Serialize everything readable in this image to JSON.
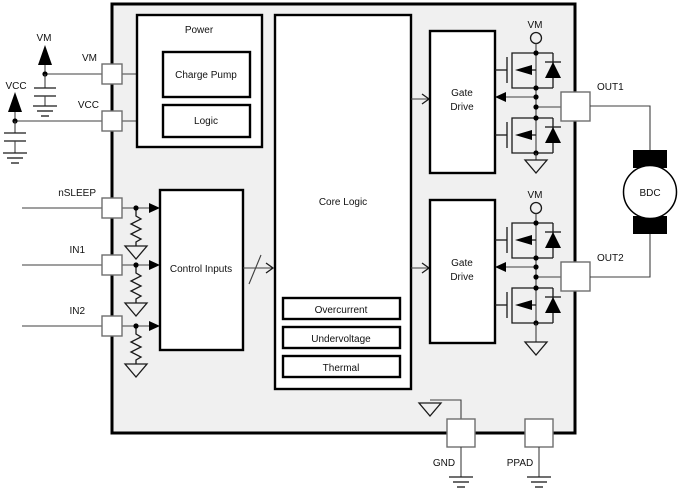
{
  "blocks": {
    "power": "Power",
    "charge_pump": "Charge Pump",
    "logic": "Logic",
    "core_logic": "Core Logic",
    "control_inputs": "Control Inputs",
    "overcurrent": "Overcurrent",
    "undervoltage": "Undervoltage",
    "thermal": "Thermal",
    "gate_drive_line1": "Gate",
    "gate_drive_line2": "Drive",
    "motor": "BDC"
  },
  "pins": {
    "vm": "VM",
    "vcc": "VCC",
    "nsleep": "nSLEEP",
    "in1": "IN1",
    "in2": "IN2",
    "out1": "OUT1",
    "out2": "OUT2",
    "gnd": "GND",
    "ppad": "PPAD"
  },
  "supplies": {
    "vm_source": "VM",
    "vcc_source": "VCC",
    "vm_bridge1": "VM",
    "vm_bridge2": "VM"
  },
  "colors": {
    "chip_fill": "#f0f0f0",
    "line": "#000000",
    "wire": "#3f3f3f"
  }
}
